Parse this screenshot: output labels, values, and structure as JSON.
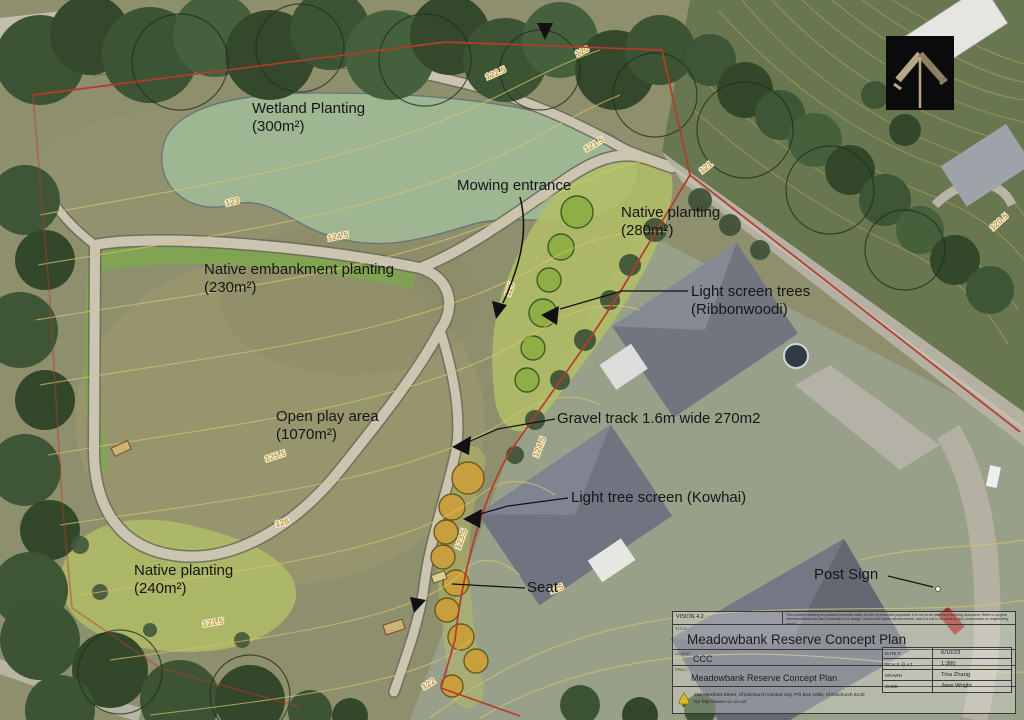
{
  "annotations": {
    "wetland": {
      "line1": "Wetland Planting",
      "line2": "(300m²)"
    },
    "mowing": {
      "line1": "Mowing entrance"
    },
    "native_ne": {
      "line1": "Native planting",
      "line2": "(280m²)"
    },
    "embankment": {
      "line1": "Native embankment planting",
      "line2": "(230m²)"
    },
    "ribbonwood": {
      "line1": "Light screen trees",
      "line2": "(Ribbonwoodi)"
    },
    "open_play": {
      "line1": "Open play area",
      "line2": "(1070m²)"
    },
    "gravel": {
      "line1": "Gravel track 1.6m wide 270m2"
    },
    "kowhai": {
      "line1": "Light tree screen (Kowhai)"
    },
    "native_sw": {
      "line1": "Native planting",
      "line2": "(240m²)"
    },
    "seat": {
      "line1": "Seat"
    },
    "post_sign": {
      "line1": "Post Sign"
    }
  },
  "contour_labels": [
    {
      "t": "123",
      "x": 226,
      "y": 206,
      "r": -12
    },
    {
      "t": "124.5",
      "x": 328,
      "y": 241,
      "r": -10
    },
    {
      "t": "122.5",
      "x": 487,
      "y": 80,
      "r": -24
    },
    {
      "t": "120",
      "x": 577,
      "y": 57,
      "r": -26
    },
    {
      "t": "121.5",
      "x": 586,
      "y": 152,
      "r": -30
    },
    {
      "t": "121",
      "x": 702,
      "y": 174,
      "r": -38
    },
    {
      "t": "130",
      "x": 926,
      "y": 91,
      "r": -36
    },
    {
      "t": "120.5",
      "x": 993,
      "y": 231,
      "r": -42
    },
    {
      "t": "125",
      "x": 510,
      "y": 297,
      "r": -72
    },
    {
      "t": "124.5",
      "x": 538,
      "y": 458,
      "r": -68
    },
    {
      "t": "125.5",
      "x": 266,
      "y": 462,
      "r": -18
    },
    {
      "t": "126",
      "x": 276,
      "y": 527,
      "r": -14
    },
    {
      "t": "123.5",
      "x": 460,
      "y": 550,
      "r": -70
    },
    {
      "t": "125",
      "x": 551,
      "y": 594,
      "r": -22
    },
    {
      "t": "121.5",
      "x": 203,
      "y": 627,
      "r": -10
    },
    {
      "t": "122",
      "x": 424,
      "y": 690,
      "r": -32
    }
  ],
  "title_block": {
    "version": "VISION 4.2",
    "disclaimer": "This concept drawing is provided herewith solely for the represented purposes. It is not to be used as a working document. Refer to original representations and land information for design, setout and further advancement, and it is not to be used for any construction or engineering setout.",
    "title_label": "TITLE",
    "title": "Meadowbank Reserve Concept Plan",
    "client_label": "CLIENT",
    "client": "CCC",
    "project_label": "PROJ",
    "project": "Meadowbank Reserve Concept Plan",
    "meta": [
      {
        "label": "DATE #",
        "value": "6/10/23"
      },
      {
        "label": "SCALE @ A3",
        "value": "1:300"
      },
      {
        "label": "DRAWN",
        "value": "Tina Zhang"
      },
      {
        "label": "CHKD",
        "value": "Jane Wright"
      }
    ],
    "address": "236 Hereford Street, Christchurch Central City, PO Box 1005, Christchurch 8140",
    "website": "NZ  http://www.ccc.co.nz/"
  },
  "colors": {
    "boundary_red": "#b73a2c",
    "contour_yellow": "#d9c46e",
    "path_gray": "#cac4b0",
    "grass_olive": "#93926c",
    "tree_green": "#42563a",
    "planting_green": "#b2c066",
    "wetland_green": "#a2bd9a",
    "kowhai_ochre": "#c79f3e",
    "roof_gray": "#71757f",
    "north_arrow_bg": "#0b0b0b"
  }
}
